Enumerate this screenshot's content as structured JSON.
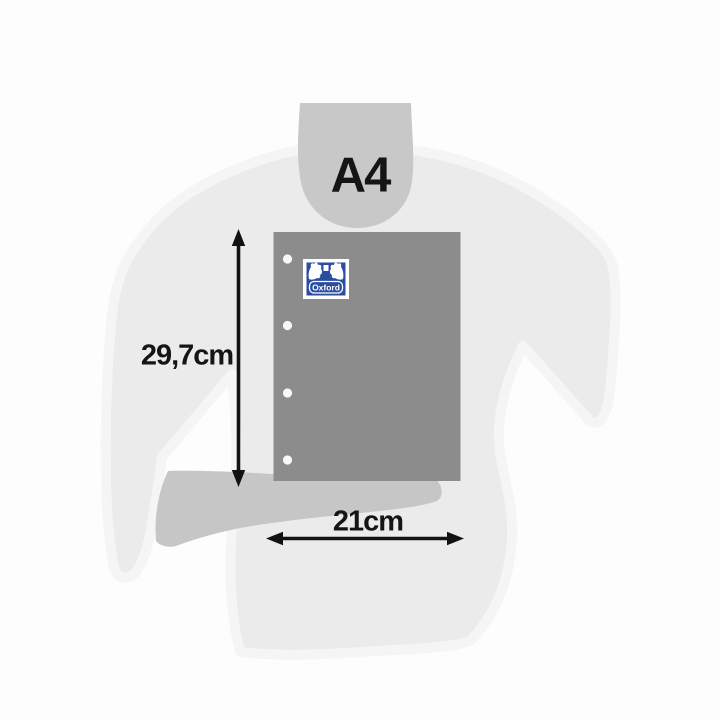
{
  "product_diagram": {
    "format_label": "A4",
    "height_label": "29,7cm",
    "width_label": "21cm",
    "brand_logo_text": "Oxford",
    "punch_holes_count": 4,
    "colors": {
      "background": "#fdfdfd",
      "body_silhouette": "#ebebeb",
      "body_halo": "#f5f5f5",
      "neck_silhouette": "#c8c8c8",
      "arm_silhouette": "#c6c6c6",
      "paper_sheet": "#8c8c8c",
      "punch_hole": "#f8f8f8",
      "dimension_ink": "#121212",
      "logo_blue": "#2b4da0",
      "logo_white": "#ffffff"
    }
  }
}
